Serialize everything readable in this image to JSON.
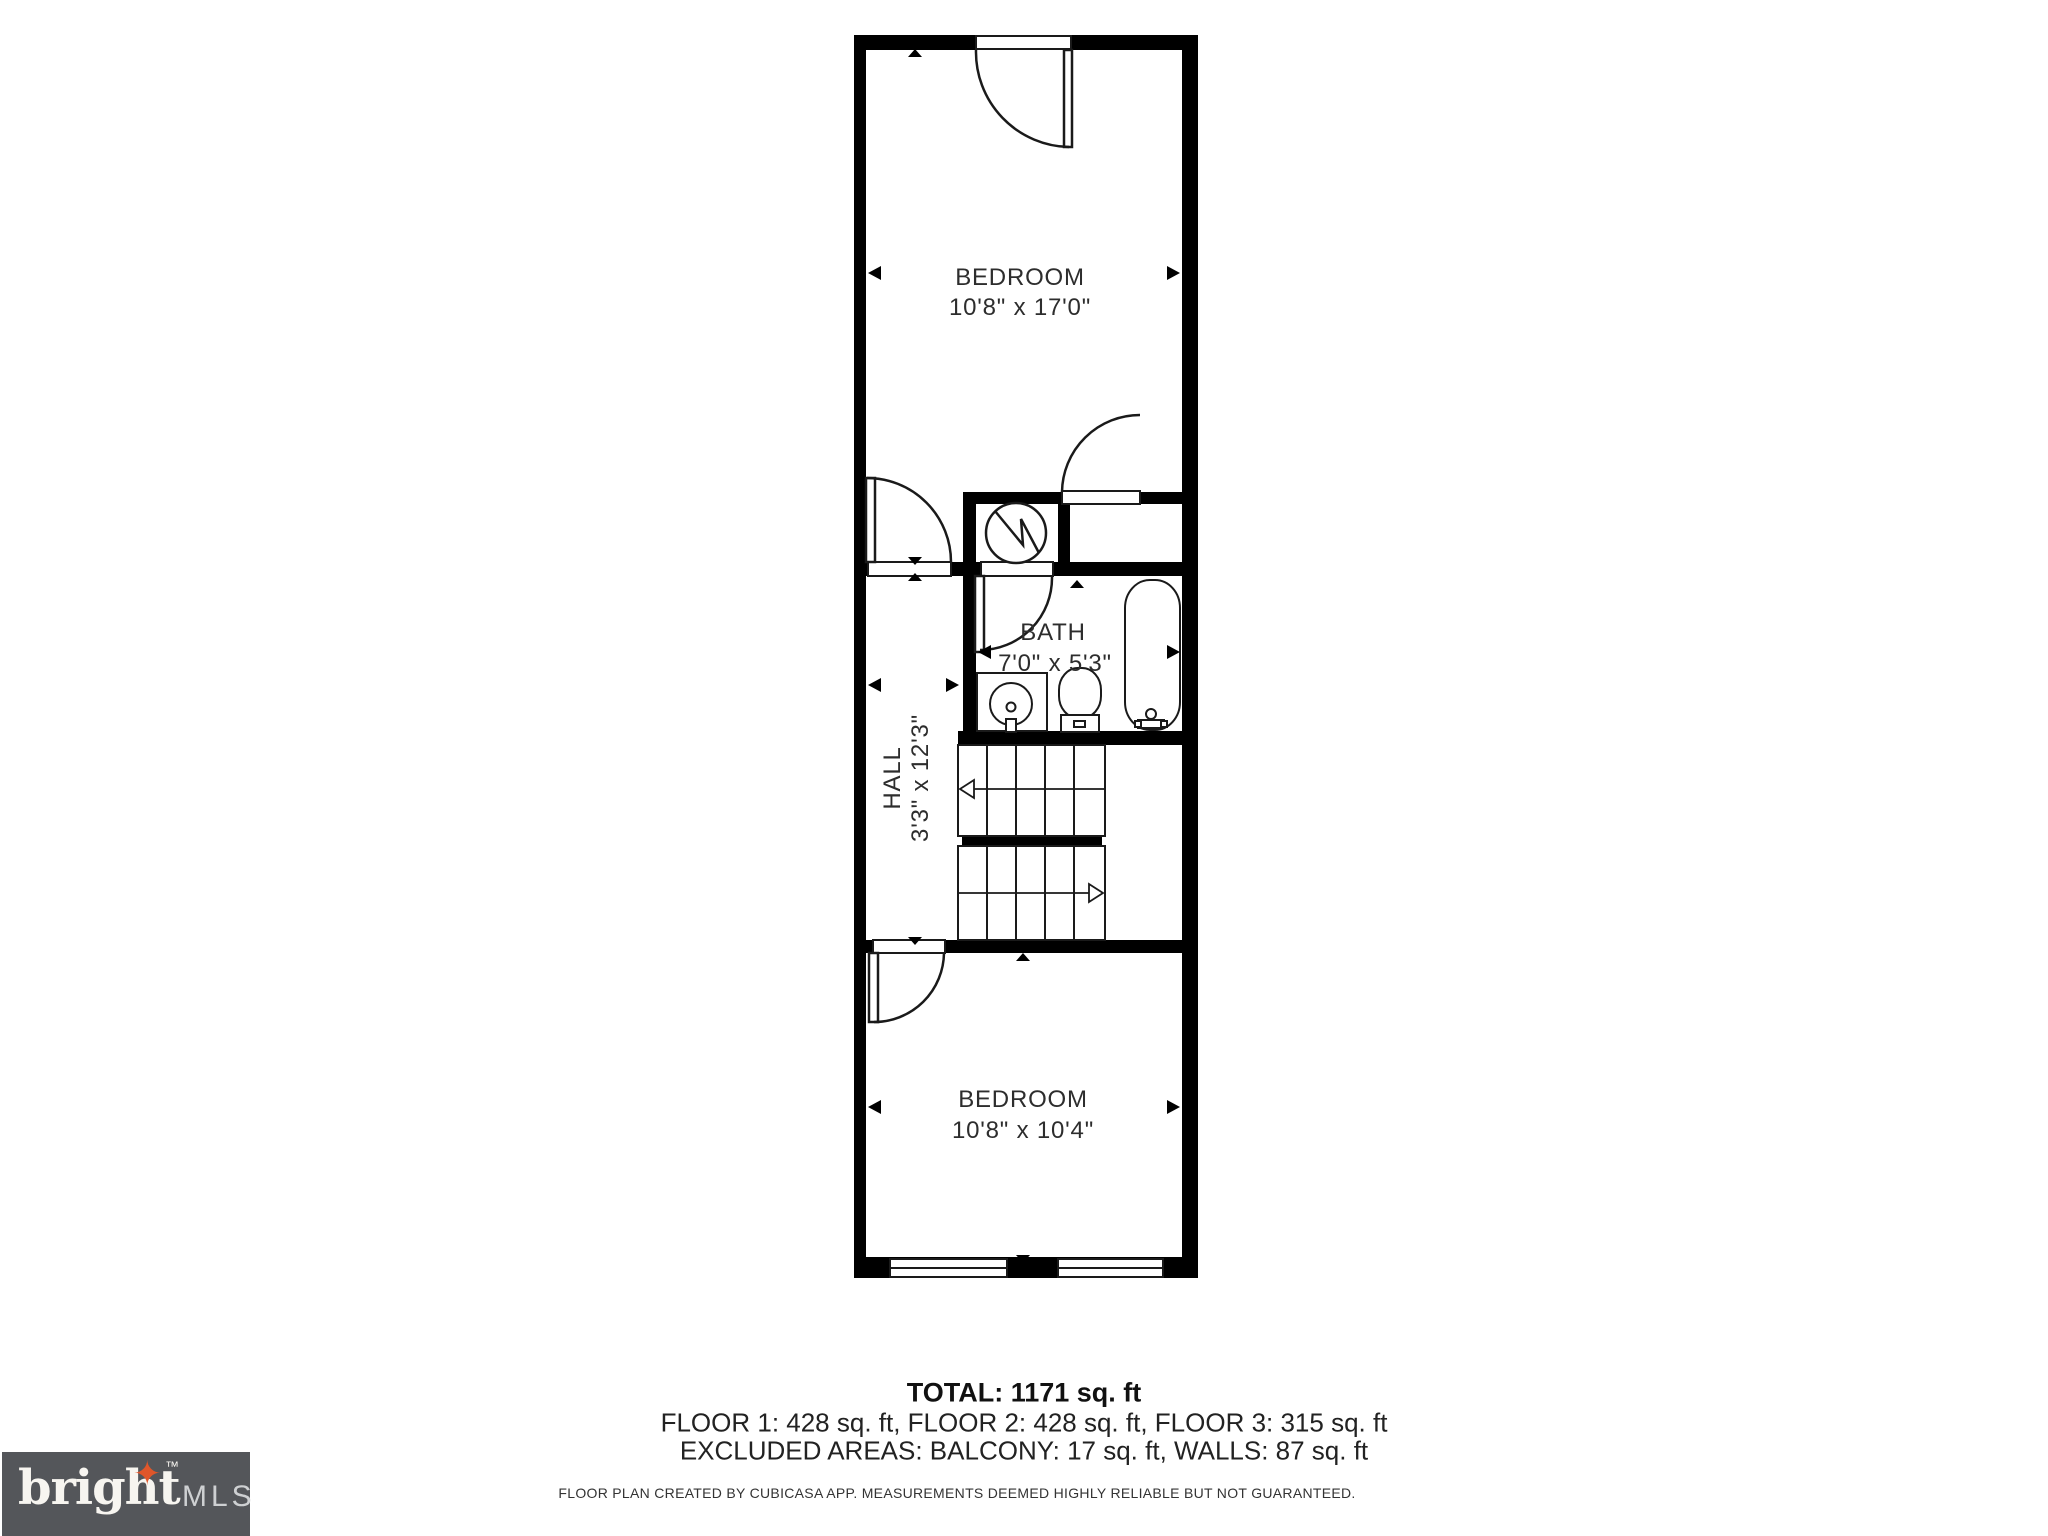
{
  "plan": {
    "rooms": [
      {
        "label": "BEDROOM",
        "dims": "10'8\" x 17'0\""
      },
      {
        "label": "BATH",
        "dims": "7'0\" x 5'3\""
      },
      {
        "label": "HALL",
        "dims": "3'3\" x 12'3\""
      },
      {
        "label": "BEDROOM",
        "dims": "10'8\" x 10'4\""
      }
    ],
    "icons": [
      "water-heater-icon",
      "sink-icon",
      "toilet-icon",
      "bathtub-icon",
      "stairs-up-arrow",
      "stairs-down-arrow"
    ]
  },
  "summary": {
    "total": "TOTAL: 1171 sq. ft",
    "floors": "FLOOR 1: 428 sq. ft, FLOOR 2: 428 sq. ft, FLOOR 3: 315 sq. ft",
    "excluded": "EXCLUDED AREAS: BALCONY: 17 sq. ft, WALLS: 87 sq. ft",
    "disclaimer": "FLOOR PLAN CREATED BY CUBICASA APP. MEASUREMENTS DEEMED HIGHLY RELIABLE BUT NOT GUARANTEED."
  },
  "logo": {
    "brand": "bright",
    "star": "✦",
    "tm": "™",
    "suffix": "MLS"
  },
  "colors": {
    "wall": "#000000",
    "line": "#1a1a1a",
    "label_text": "#2d2d2d",
    "logo_bg": "#54565a",
    "logo_star": "#e0562a",
    "logo_brand": "#f7f5f0",
    "logo_mls": "#ced0d2"
  }
}
